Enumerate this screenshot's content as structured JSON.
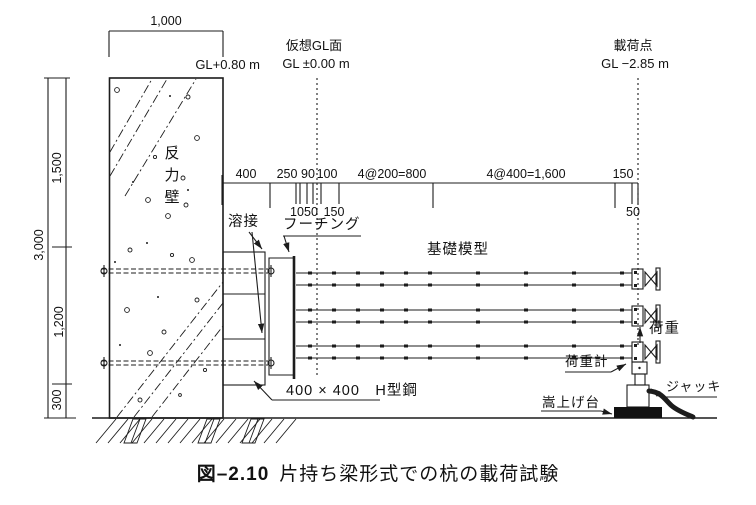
{
  "colors": {
    "ink": "#1c1c1c",
    "paper": "#ffffff"
  },
  "annotations": {
    "top_width": "1,000",
    "wall_top_level": "GL+0.80 m",
    "virtual_gl_title": "仮想GL面",
    "virtual_gl_level": "GL ±0.00 m",
    "load_point_title": "載荷点",
    "load_point_level": "GL −2.85 m",
    "wall_label": "反力壁",
    "weld": "溶接",
    "footing": "フーチング",
    "foundation_model": "基礎模型",
    "h_beam": "400 × 400　H型鋼",
    "load": "荷重",
    "load_cell": "荷重計",
    "jack": "ジャッキ",
    "riser_stand": "嵩上げ台"
  },
  "vertical_dims": {
    "total": "3,000",
    "upper": "1,500",
    "middle": "1,200",
    "lower": "300"
  },
  "horizontal_dims": {
    "top_row": [
      "400",
      "250",
      "90",
      "100",
      "4@200=800",
      "4@400=1,600",
      "150"
    ],
    "sub_row": [
      "10",
      "50",
      "150"
    ],
    "sub_right": "50"
  },
  "caption": {
    "number": "図–2.10",
    "text": "片持ち梁形式での杭の載荷試験"
  }
}
